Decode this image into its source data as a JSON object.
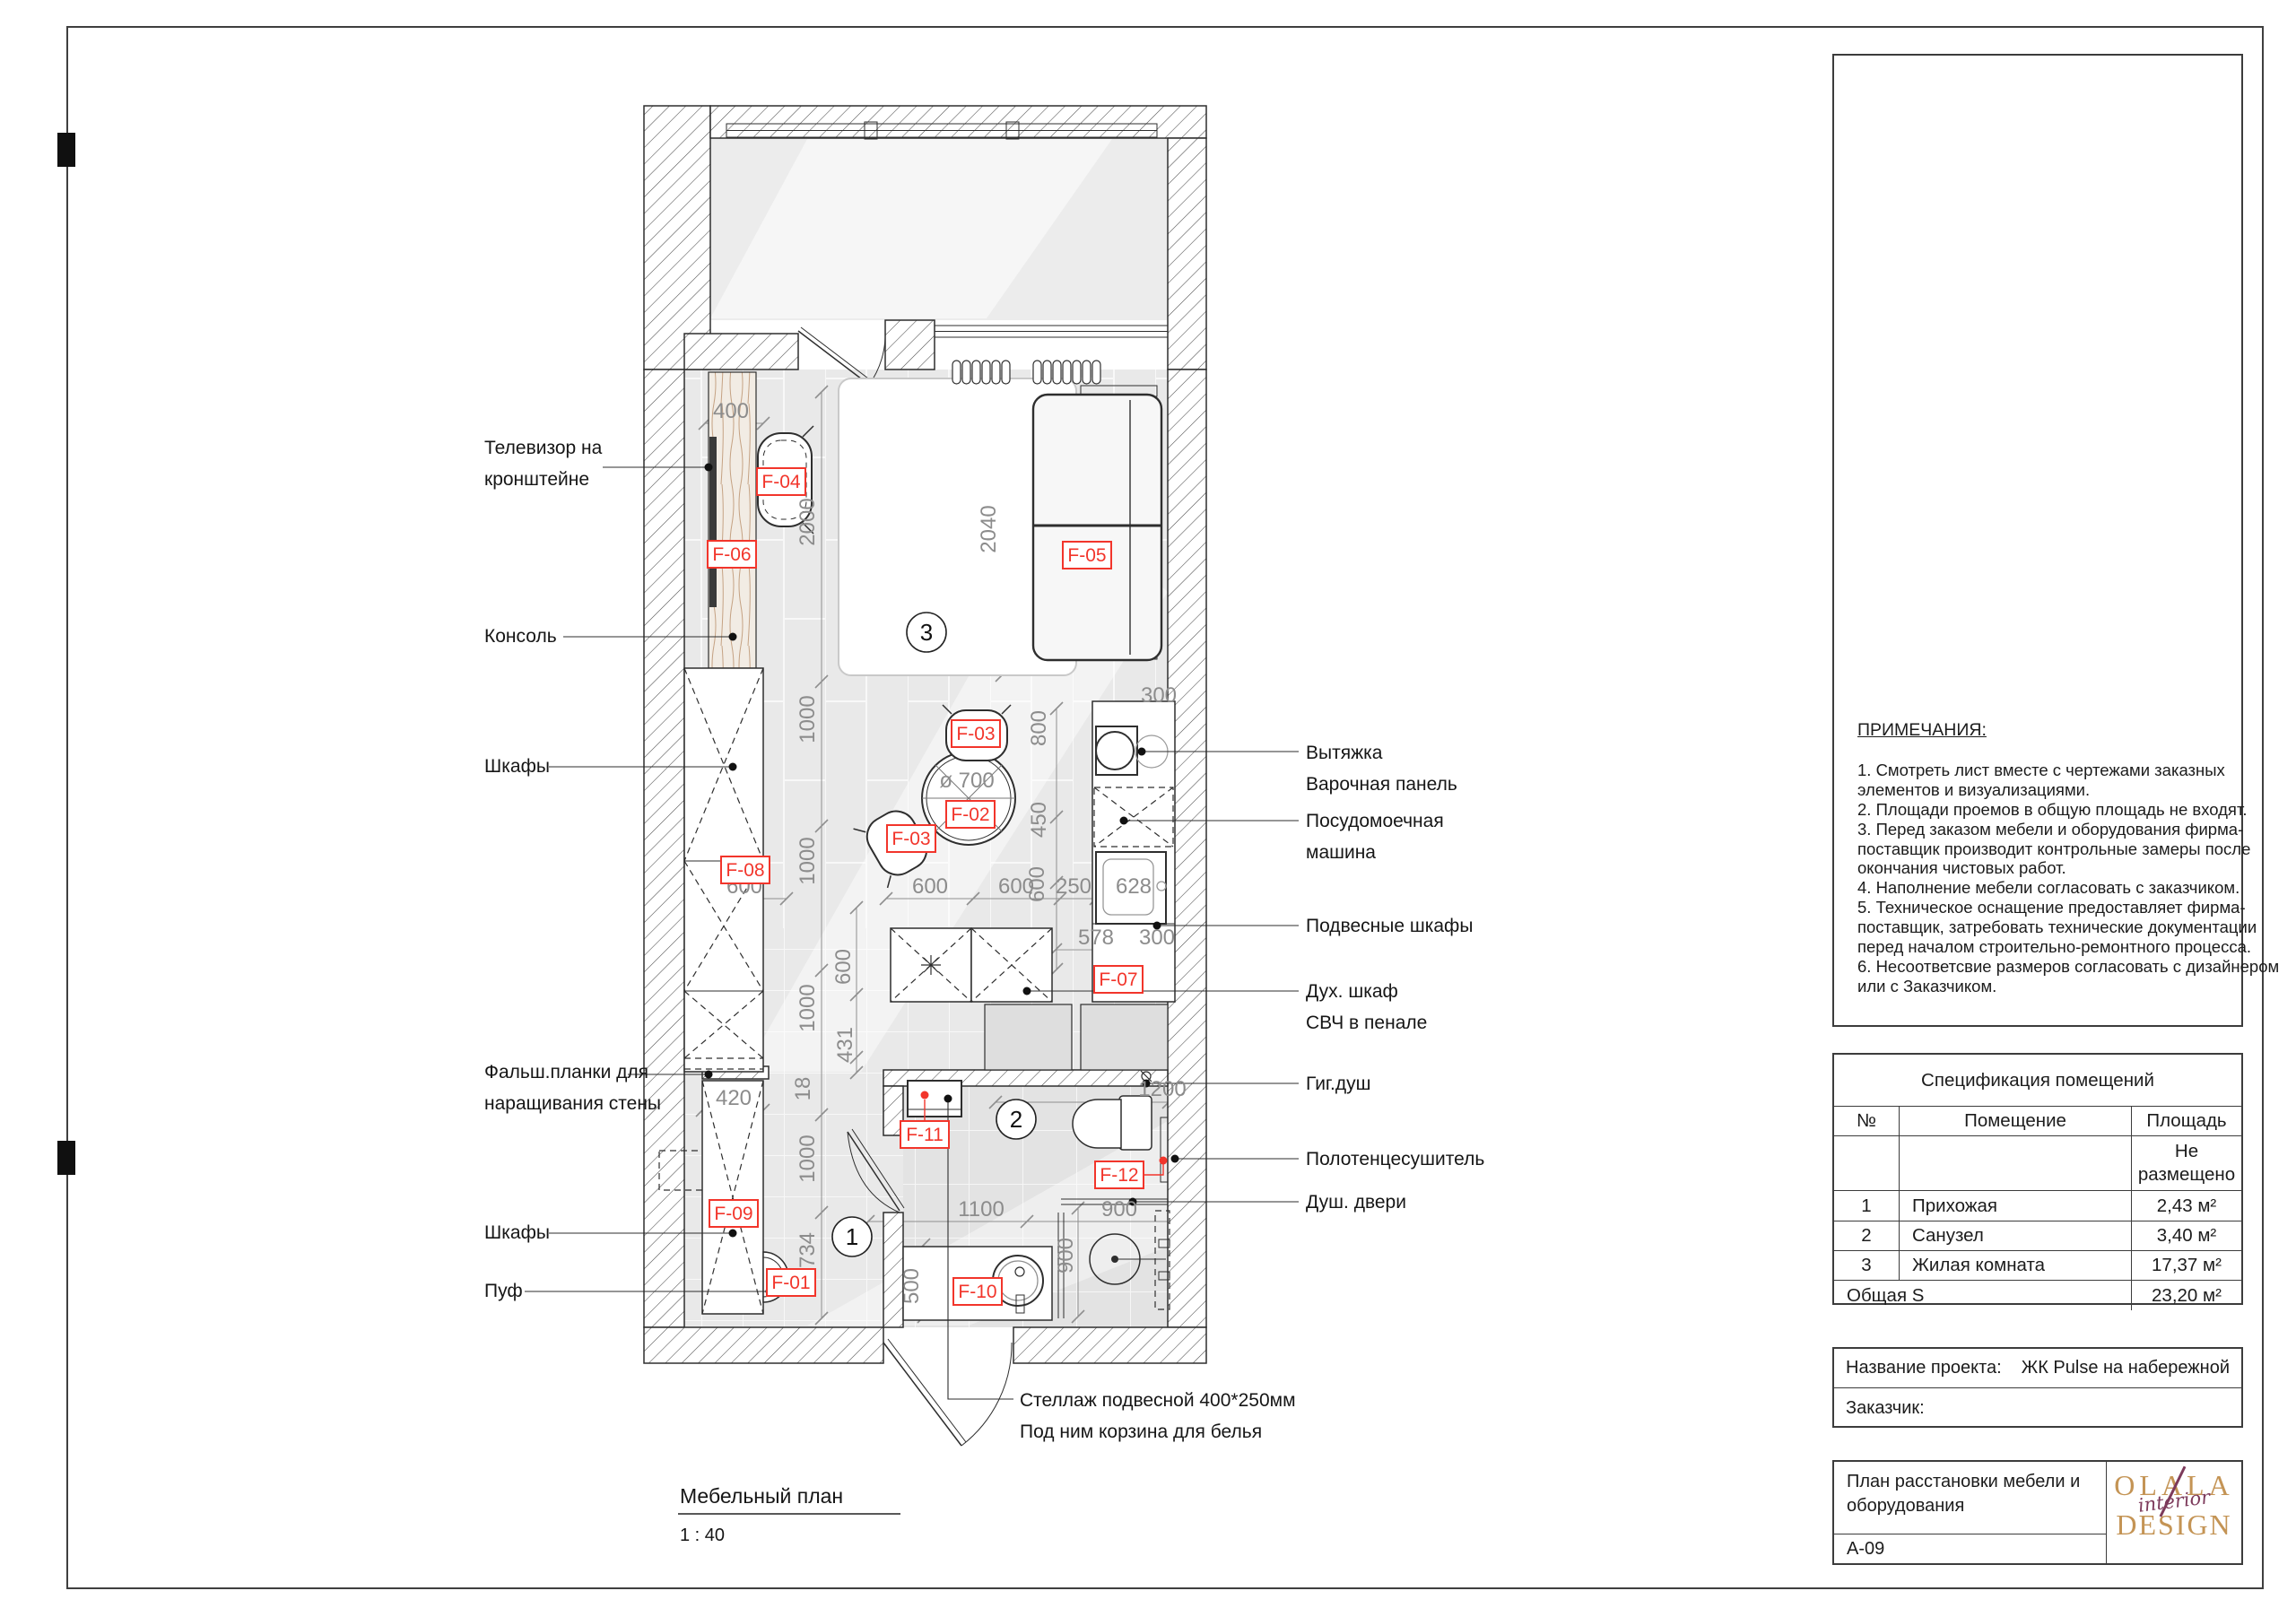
{
  "colors": {
    "accent_red": "#f2352b",
    "logo_gold": "#c49455",
    "logo_plum": "#7d3a5b"
  },
  "notes": {
    "heading": "ПРИМЕЧАНИЯ:",
    "lines": [
      "1. Смотреть лист вместе с чертежами заказных",
      "элементов и визуализациями.",
      "2. Площади проемов в общую площадь не входят.",
      "3. Перед заказом мебели и оборудования фирма-",
      "поставщик производит контрольные замеры после",
      "окончания чистовых работ.",
      "4. Наполнение мебели согласовать с заказчиком.",
      "5. Техническое оснащение предоставляет фирма-",
      "поставщик, затребовать технические документации",
      "перед началом строительно-ремонтного процесса.",
      "6. Несоответсвие размеров согласовать с дизайнером",
      "или с Заказчиком."
    ]
  },
  "spec": {
    "title": "Спецификация помещений",
    "col_num": "№",
    "col_room": "Помещение",
    "col_area": "Площадь",
    "unplaced_1": "Не",
    "unplaced_2": "размещено",
    "rows": [
      [
        "1",
        "Прихожая",
        "2,43 м²"
      ],
      [
        "2",
        "Санузел",
        "3,40 м²"
      ],
      [
        "3",
        "Жилая комната",
        "17,37 м²"
      ]
    ],
    "total_label": "Общая S",
    "total_value": "23,20 м²"
  },
  "project": {
    "name_label": "Название проекта:",
    "name_value": "ЖК Pulse на набережной",
    "client_label": "Заказчик:"
  },
  "title_block": {
    "sheet_name_1": "План расстановки мебели и",
    "sheet_name_2": "оборудования",
    "sheet_code": "A-09",
    "logo_top": "OLALA",
    "logo_script": "interior",
    "logo_bottom": "DESIGN"
  },
  "plan": {
    "title": "Мебельный план",
    "scale_note": "1 : 40",
    "room_markers": [
      "1",
      "2",
      "3"
    ],
    "furniture_tags": [
      "F-01",
      "F-02",
      "F-03",
      "F-03",
      "F-04",
      "F-05",
      "F-06",
      "F-07",
      "F-08",
      "F-09",
      "F-10",
      "F-11",
      "F-12"
    ],
    "table_diameter": "ø 700",
    "dims": [
      "400",
      "300",
      "600",
      "600",
      "600",
      "250",
      "628",
      "578",
      "300",
      "420",
      "1200",
      "1100",
      "900",
      "2000",
      "2040",
      "800",
      "1000",
      "450",
      "1000",
      "600",
      "1000",
      "600",
      "431",
      "18",
      "1000",
      "734",
      "500",
      "900"
    ]
  },
  "callouts_left": [
    [
      "Телевизор на",
      "кронштейне"
    ],
    [
      "Консоль"
    ],
    [
      "Шкафы"
    ],
    [
      "Фальш.планки для",
      "наращивания стены"
    ],
    [
      "Шкафы"
    ],
    [
      "Пуф"
    ]
  ],
  "callouts_right": [
    [
      "Вытяжка",
      "Варочная панель"
    ],
    [
      "Посудомоечная",
      "машина"
    ],
    [
      "Подвесные шкафы"
    ],
    [
      "Дух. шкаф",
      "СВЧ в пенале"
    ],
    [
      "Гиг.душ"
    ],
    [
      "Полотенцесушитель"
    ],
    [
      "Душ. двери"
    ]
  ],
  "callout_bottom": [
    "Стеллаж подвесной 400*250мм",
    "Под ним корзина для белья"
  ]
}
